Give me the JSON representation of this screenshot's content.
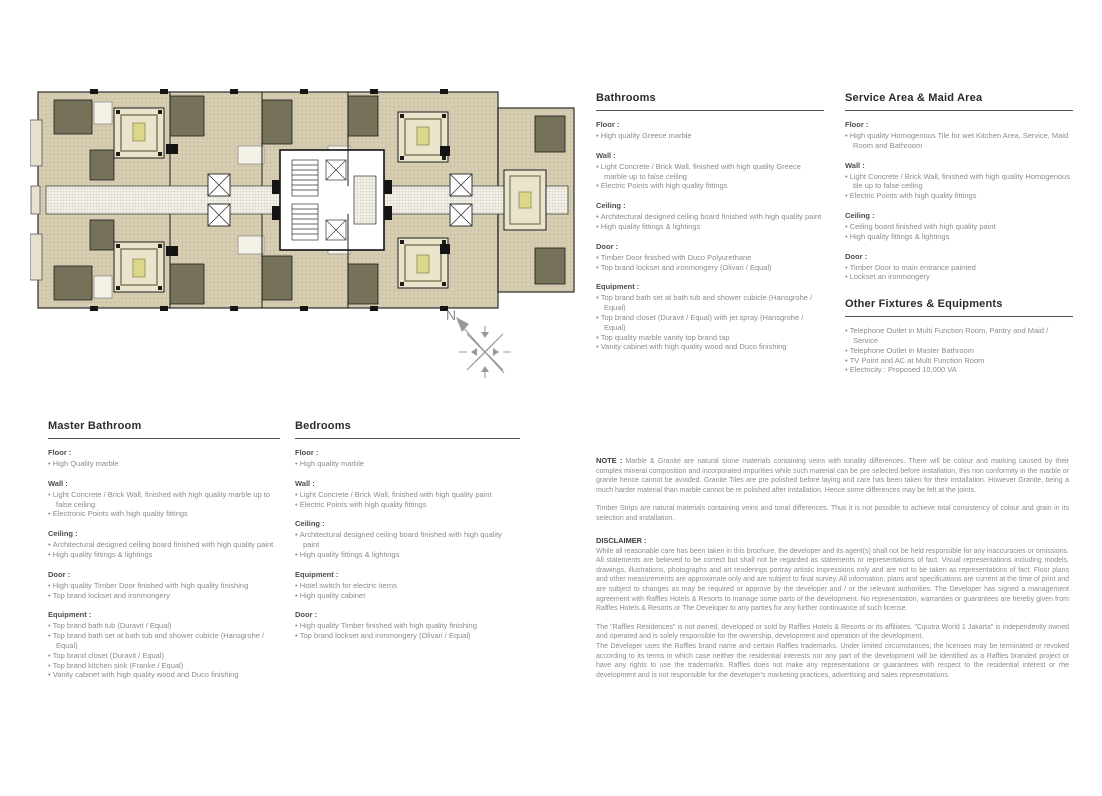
{
  "plan": {
    "compass_label": "N",
    "colors": {
      "tile_beige": "#d7ceb3",
      "tile_line": "#b9ae90",
      "room_olive": "#76725a",
      "wall_black": "#1c1c1c",
      "bed_accent": "#dcd98b",
      "room_light": "#eae4cd",
      "compass_gray": "#999999"
    }
  },
  "specs": {
    "bathrooms": {
      "title": "Bathrooms",
      "groups": [
        {
          "label": "Floor :",
          "items": [
            "High quality Greece marble"
          ]
        },
        {
          "label": "Wall :",
          "items": [
            "Light Concrete / Brick Wall, finished with high quality Greece marble up to false ceiling",
            "Electric Points with high quality fittings"
          ]
        },
        {
          "label": "Ceiling :",
          "items": [
            "Architectural designed ceiling board finished with high quality paint",
            "High quality fittings & lightings"
          ]
        },
        {
          "label": "Door :",
          "items": [
            "Timber Door finished with Duco Polyurethane",
            "Top brand lockset and ironmongery (Olivari / Equal)"
          ]
        },
        {
          "label": "Equipment :",
          "items": [
            "Top brand bath set at bath tub and shower cubicle (Hansgrohe / Equal)",
            "Top brand closet (Duravit / Equal) with jet spray (Hansgrohe / Equal)",
            "Top quality marble vanity top brand tap",
            "Vanity cabinet with high quality wood and Duco finishing"
          ]
        }
      ]
    },
    "service": {
      "title": "Service Area & Maid Area",
      "groups": [
        {
          "label": "Floor :",
          "items": [
            "High quality Homogenous Tile for wet Kitchen Area, Service, Maid Room and Bathroom"
          ]
        },
        {
          "label": "Wall :",
          "items": [
            "Light Concrete / Brick Wall, finished with high quality Homogenous tile up to false ceiling",
            "Electric Points with high quality fittings"
          ]
        },
        {
          "label": "Ceiling :",
          "items": [
            "Ceiling board finished with high quality paint",
            "High quality fittings & lightings"
          ]
        },
        {
          "label": "Door :",
          "items": [
            "Timber Door to main entrance painted",
            "Lockset an ironmongery"
          ]
        }
      ]
    },
    "other": {
      "title": "Other Fixtures & Equipments",
      "items": [
        "Telephone Outlet in Multi Function Room, Pantry and Maid / Service",
        "Telephone Outlet in Master Bathroom",
        "TV Point and AC at Multi Function Room",
        "Electricity : Proposed 10,000 VA"
      ]
    },
    "master": {
      "title": "Master Bathroom",
      "groups": [
        {
          "label": "Floor :",
          "items": [
            "High Quality marble"
          ]
        },
        {
          "label": "Wall :",
          "items": [
            "Light Concrete / Brick Wall, finished with high quality marble up to false ceiling",
            "Electronic Points with high quality fittings"
          ]
        },
        {
          "label": "Ceiling :",
          "items": [
            "Architectural designed ceiling board finished with high quality paint",
            "High quality fittings & lightings"
          ]
        },
        {
          "label": "Door :",
          "items": [
            "High quality Timber Door finished with high quality finishing",
            "Top brand lockset and ironmongery"
          ]
        },
        {
          "label": "Equipment :",
          "items": [
            "Top brand bath tub (Duravit / Equal)",
            "Top brand bath set at bath tub and shower cubicle (Hansgrohe / Equal)",
            "Top brand closet (Duravit / Equal)",
            "Top brand kitchen sink (Franke / Equal)",
            "Vanity cabinet with high quality wood and Duco finishing"
          ]
        }
      ]
    },
    "bedrooms": {
      "title": "Bedrooms",
      "groups": [
        {
          "label": "Floor :",
          "items": [
            "High quality marble"
          ]
        },
        {
          "label": "Wall :",
          "items": [
            "Light Concrete / Brick Wall, finished with high quality paint",
            "Electric Points with high quality fittings"
          ]
        },
        {
          "label": "Ceiling :",
          "items": [
            "Architectural designed ceiling board finished with high quality paint",
            "High quality fittings & lightings"
          ]
        },
        {
          "label": "Equipment :",
          "items": [
            "Hotel switch for electric items",
            "High quality cabinet"
          ]
        },
        {
          "label": "Door :",
          "items": [
            "High quality Timber finished with high quality finishing",
            "Top brand lockset and ironmongery (Olivari / Equal)"
          ]
        }
      ]
    }
  },
  "note": {
    "label": "NOTE :",
    "p1": "Marble & Granite are natural stone materials containing veins with tonality differences. There will be colour and marking caused by their complex mineral composition and incorporated impurities while such material can be pre selected before installation, this non conformity in the marble or granite hence cannot be avoided. Granite Tiles are pre polished before laying and care has been taken for their installation. However Granite, being a much harder material than marble cannot be re polished after installation. Hence some differences may be felt at the joints.",
    "p2": "Timber Strips are natural materials containing veins and tonal differences. Thus it is not possible to achieve total consistency of colour and grain in its selection and installation."
  },
  "disclaimer": {
    "label": "DISCLAIMER :",
    "p1": "While all reasonable care has been taken in this brochure, the developer and its agent(s) shall not be held responsible for any inaccuracies or omissions. All statements are believed to be correct but shall not be regarded as statements or representations of fact. Visual representations including models, drawings, illustrations, photographs and art renderings portray artistic impressions only and are not to be taken as representations of fact. Floor plans and other measurements are approximate only and are subject to final survey.  All information, plans and specifications are current at the time of print and are subject to changes as may be required or approve by the developer and / or the relevant authorities. The Developer has signed a management agreement with Raffles Hotels & Resorts to manage some parts of the development. No representation, warranties or guarantees are hereby given from Raffles Hotels & Resorts or The Developer to any parties for any further continuance of such license.",
    "p2": "The \"Raffles Residences\" is not owned, developed or sold by Raffles Hotels & Resorts or its affiliates. \"Ciputra World 1 Jakarta\" is independently owned and operated and is solely responsible for the ownership, development and operation of the development.",
    "p3": "The Developer uses the Raffles brand name and certain Raffles trademarks. Under limited circumstances, the licenses may be terminated or revoked according to its terms in which case neither the residential interests nor any part of the development will be identified as a Raffles branded project or have any rights to use the trademarks. Raffles does not make any representations or guarantees with respect to the residential interest or rhe development and is not responsible for the developer's marketing practices, advertising and sales representations."
  }
}
